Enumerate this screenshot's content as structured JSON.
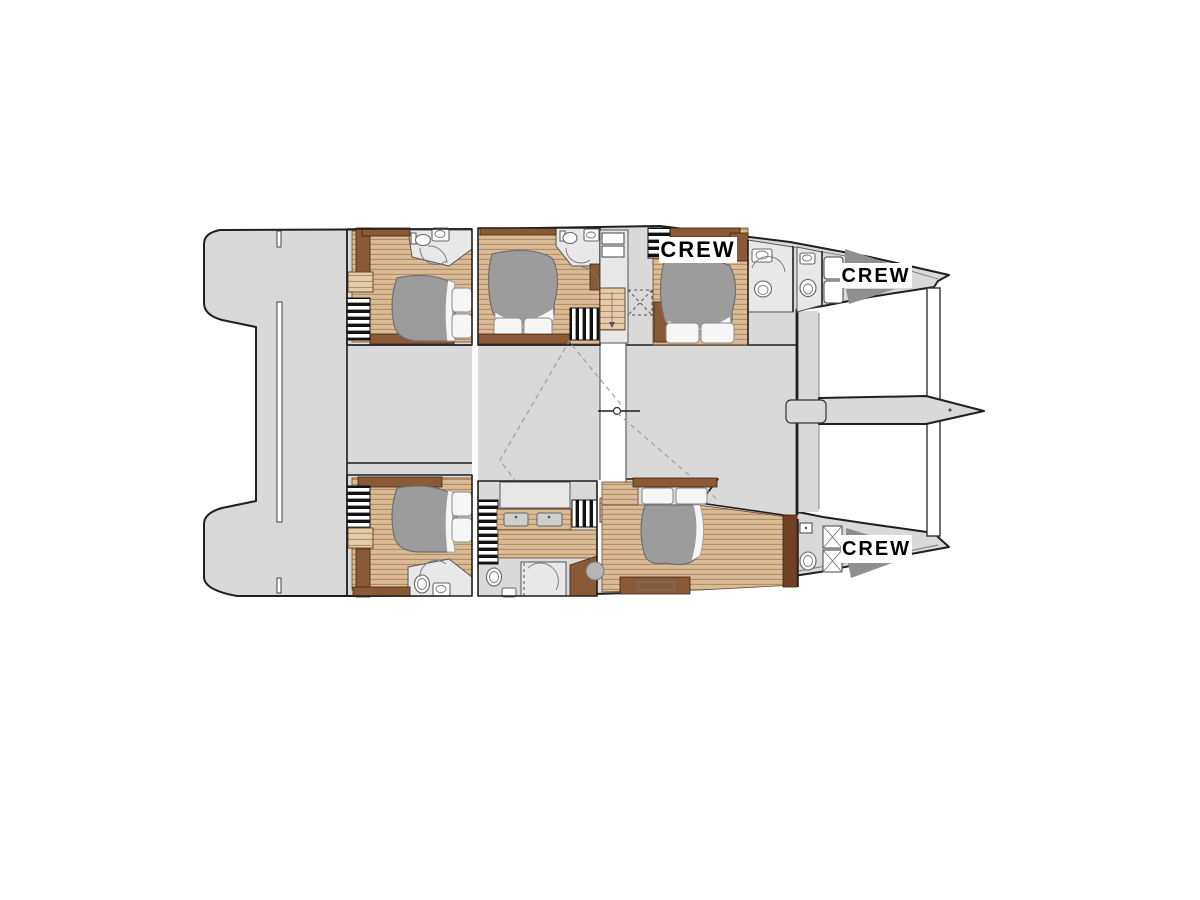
{
  "figure": {
    "type": "yacht-floor-plan",
    "description": "Catamaran lower deck layout plan, bow to the right, with guest cabins, bathrooms, galley and crew quarters",
    "labels": {
      "crew_fwd_port": "CREW",
      "crew_bow_port": "CREW",
      "crew_bow_starboard": "CREW"
    }
  },
  "colors": {
    "hull_fill": "#d9d9d9",
    "outline": "#1f1f1f",
    "room_fill": "#e8e8e8",
    "wood_light": "#d9bb98",
    "wood_stripe": "#b48a5e",
    "wood_dark": "#8a5a36",
    "wood_darker": "#6e4223",
    "bed_duvet": "#9c9c9c",
    "bed_linen": "#f6f6f6",
    "berth_dark": "#8f8f8f",
    "label_bg": "#ffffff",
    "label_text": "#000000",
    "background": "#ffffff"
  }
}
